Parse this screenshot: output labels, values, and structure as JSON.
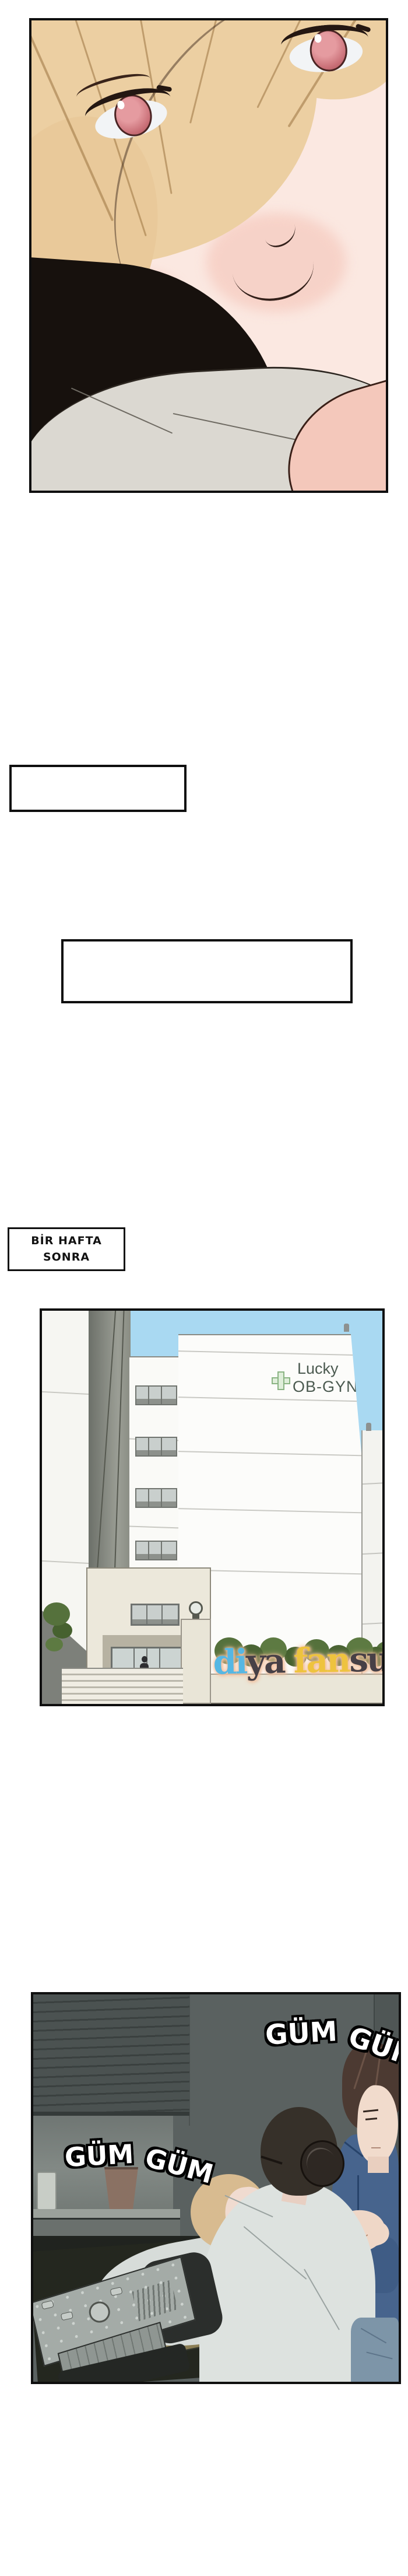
{
  "time_caption": {
    "line1": "BİR HAFTA",
    "line2": "SONRA"
  },
  "captions": {
    "box1_text": "",
    "box2_text": ""
  },
  "building_panel": {
    "sign_line1": "Lucky",
    "sign_line2": "OB-GYN",
    "watermark": {
      "p1": "di",
      "p2": "ya",
      "p3": "fan",
      "p4": "sub"
    }
  },
  "clinic_panel": {
    "sfx_top_word1": "GÜM",
    "sfx_top_word2": "GÜM",
    "sfx_left_word1": "GÜM",
    "sfx_left_word2": "GÜM"
  },
  "colors": {
    "panel_border": "#0f0f0f",
    "sky": "#a9d9f2",
    "sign_text": "#4b5a50",
    "sign_cross_fill": "#dfeeda",
    "sign_cross_border": "#8ab483",
    "watermark_blue": "#56b7e3",
    "watermark_dark": "#474046",
    "watermark_yellow": "#eec33e",
    "watermark_glow": "#f4c3a1",
    "dark_room_wall": "#5a6160",
    "man_shirt_blue": "#47648d",
    "sfx_fill": "#ffffff",
    "sfx_outline": "#000000"
  }
}
